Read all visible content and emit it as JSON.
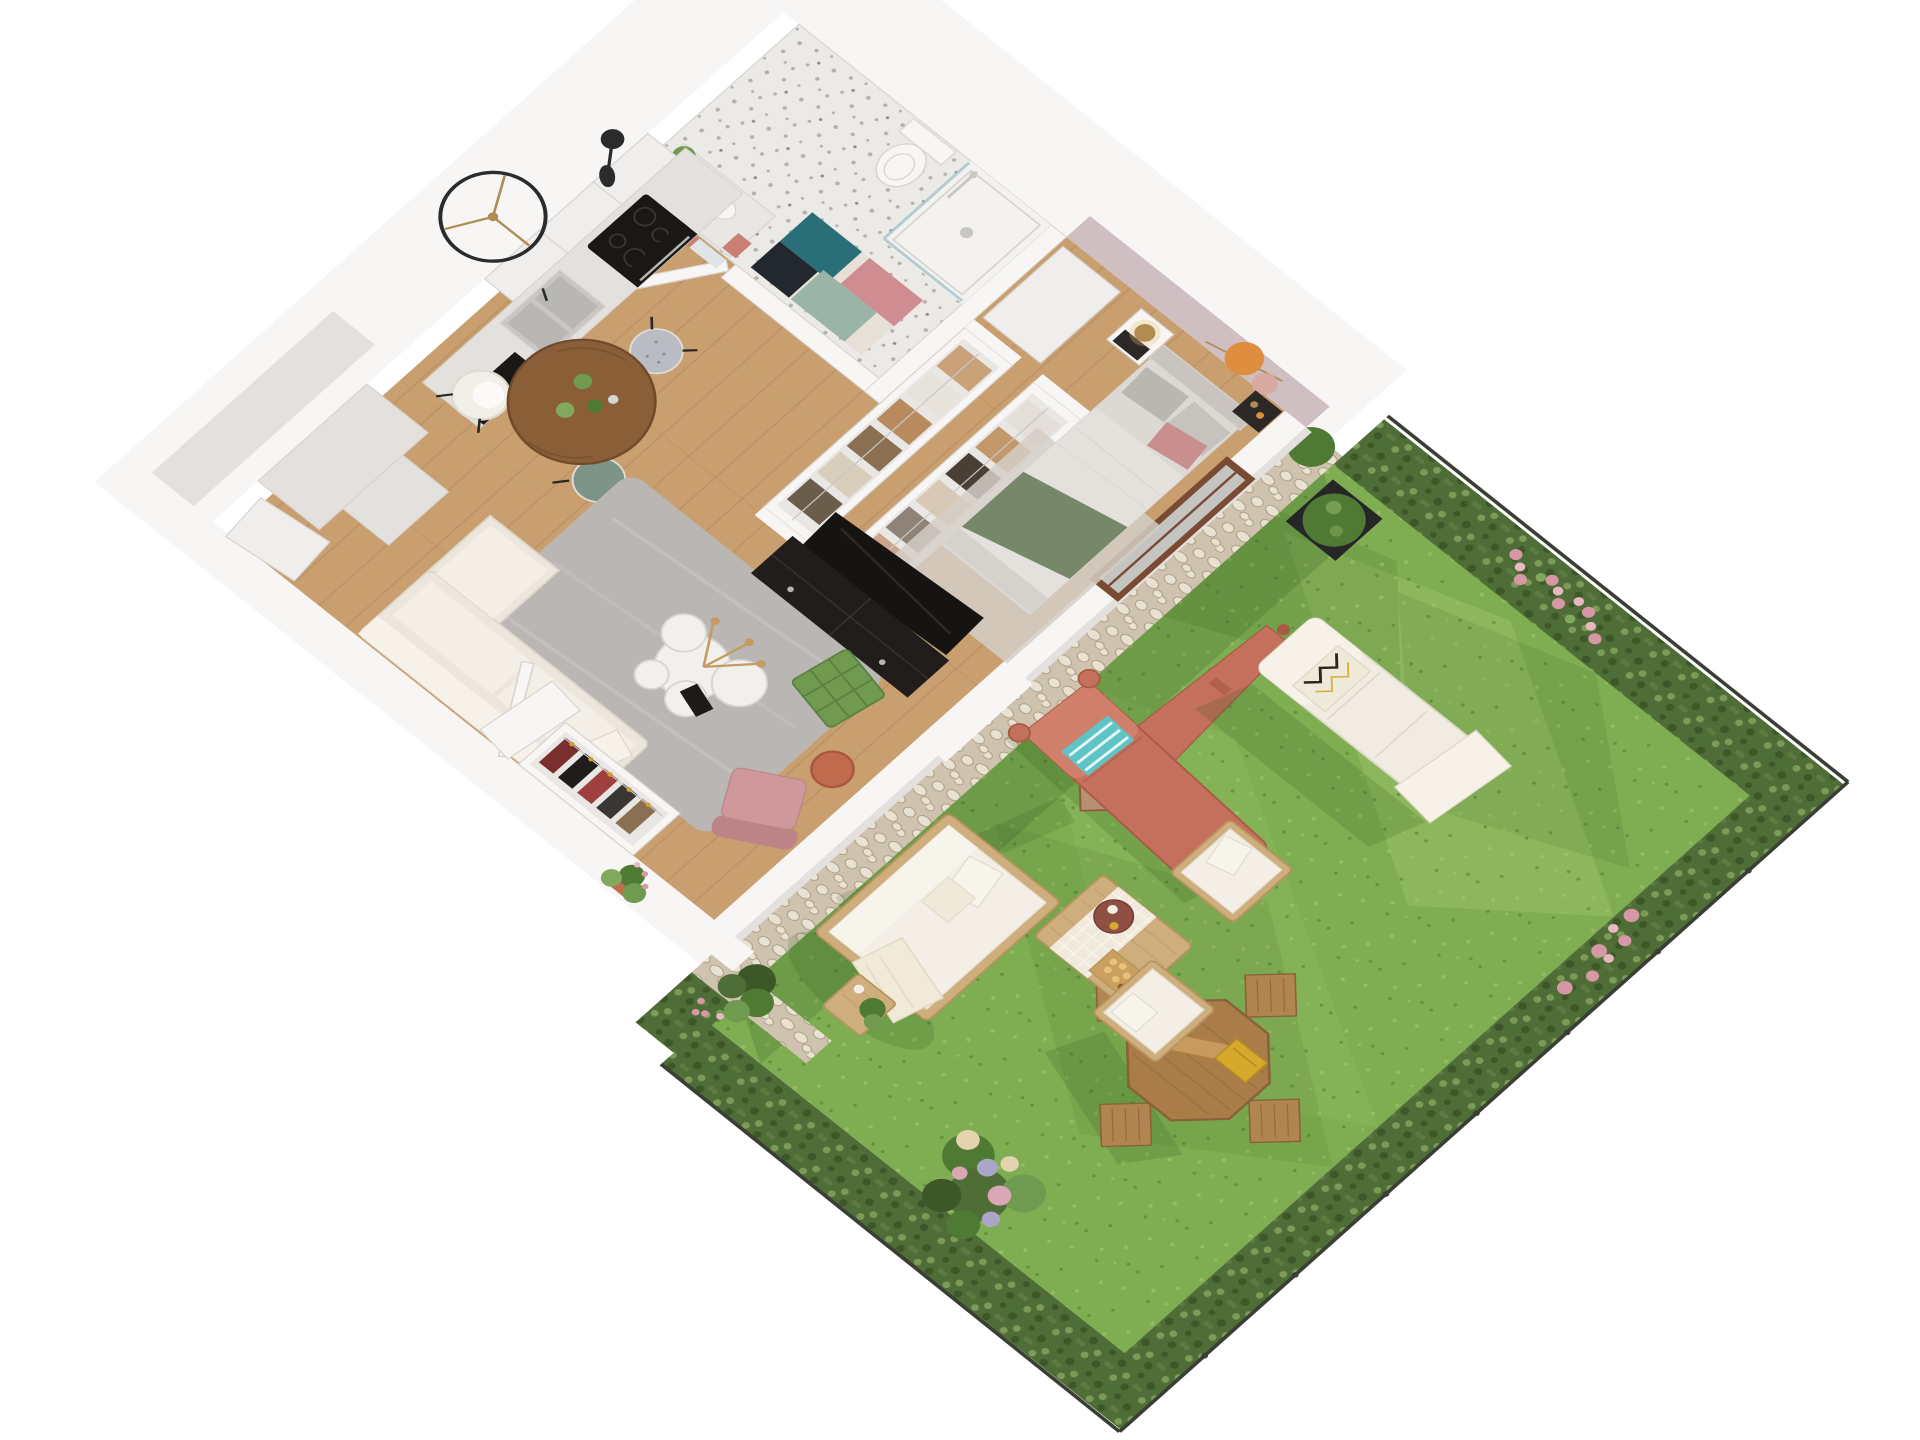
{
  "scene": {
    "view": "axonometric-3d-floor-plan-render",
    "apartment": {
      "rooms": {
        "bathroom": [
          "shower",
          "toilet",
          "vanity-sink",
          "mirror",
          "bath-mat",
          "bath-door",
          "terrazzo-floor"
        ],
        "walk-through-closet": [
          "wardrobe-row-a",
          "wardrobe-row-b",
          "hall-cabinet"
        ],
        "bedroom": [
          "double-bed",
          "green-throw",
          "nightstand-left",
          "nightstand-right",
          "brass-lamp",
          "wall-art-discs",
          "accent-wall",
          "bedroom-rug",
          "garden-door"
        ],
        "kitchen": [
          "upper-cabinets",
          "counter",
          "cooktop",
          "oven",
          "sink",
          "dishwasher",
          "island-blocks",
          "wall-clock",
          "wall-lamp"
        ],
        "dining": [
          "round-wood-table",
          "chair-white",
          "chair-sage",
          "chair-gray",
          "table-plants"
        ],
        "living": [
          "area-rug",
          "cream-sofa",
          "green-pouf",
          "coffee-table-cluster",
          "rust-side-table",
          "pink-armchair",
          "tv-console",
          "tv"
        ],
        "entry": [
          "front-door",
          "entry-closet-coats",
          "leaning-panel",
          "entry-plant"
        ]
      }
    },
    "garden": {
      "objects": [
        "lawn",
        "pebble-border",
        "hedge-top",
        "hedge-right",
        "hedge-bottom",
        "fence",
        "boxwood-planter",
        "closed-parasol",
        "white-lounger",
        "coral-lounger",
        "octagonal-dining-table",
        "folding-chairs",
        "garden-sofa",
        "garden-coffee-table",
        "garden-armchairs",
        "garden-side-table",
        "hydrangea-bush",
        "flower-shrubs",
        "corner-bush"
      ]
    }
  },
  "colors": {
    "wall": "#f7f6f5",
    "wall_shade": "#e3e0dd",
    "wall_edge": "#d7d4d0",
    "accent_wall": "#cfbfc3",
    "wood_floor": "#c99f6f",
    "wood_line": "#b2875c",
    "terrazzo": "#eceae7",
    "terrazzo_dot": "#b5b0aa",
    "terrazzo_dot2": "#8f8a84",
    "shower_floor": "#f3f2f0",
    "fixture": "#f7f6f4",
    "fixture_edge": "#d8d5d1",
    "steel": "#c9c7c4",
    "glass": "#a9c7cf",
    "mirror_base": "#dfe5e6",
    "mirror_teal": "#1f5e66",
    "mirror_pink": "#c97f72",
    "mat_teal": "#2a6f77",
    "mat_black": "#23272e",
    "mat_pink": "#cf8d92",
    "mat_sage": "#9ab5a8",
    "mat_cream": "#e6e0d6",
    "plant_green": "#6f9a4f",
    "plant_dark": "#4e7a33",
    "plant_light": "#82a85e",
    "cabinet": "#efeeec",
    "counter": "#e3e1de",
    "appliance_black": "#1a1817",
    "appliance_detail": "#b9b7b4",
    "dishwasher_light": "#3fd6d6",
    "clock_black": "#2b2b2b",
    "brass": "#b08c51",
    "lamp_glow": "#e8c178",
    "table_wood": "#8a5f38",
    "table_wood_dark": "#6f4a2b",
    "glass2": "#cfd8d2",
    "chair_white": "#f2efe9",
    "chair_white_edge": "#e0dcd4",
    "chair_sage": "#7d9488",
    "chair_gray": "#b9bcc4",
    "leg_black": "#2a2725",
    "rug": "#b9b6b4",
    "rug_light": "#c6c3c1",
    "sofa": "#ece6dc",
    "sofa_cushion": "#f3efe7",
    "sofa_back": "#f6f2ea",
    "sofa_edge": "#ddd6ca",
    "pouf_green": "#6f9a4f",
    "pouf_line": "#5a8140",
    "coffee_white": "#f2f0ec",
    "dried_tan": "#c39b63",
    "book_black": "#1d1b1a",
    "rust": "#c06a4e",
    "rust_dark": "#a85640",
    "armchair_pink": "#cf999c",
    "armchair_pink_dark": "#bd8487",
    "tv_black": "#201d1c",
    "tv_screen": "#161412",
    "tv_detail": "#3a3633",
    "closet_inner": "#e9e7e4",
    "wa1": "#caa27a",
    "wa2": "#e8e3da",
    "wa3": "#b88a5e",
    "wa4": "#8a6f52",
    "wa5": "#d9cdbb",
    "wa6": "#6b5d4c",
    "wb1": "#e3ded6",
    "wb2": "#c2976a",
    "wb3": "#4a3f35",
    "wb4": "#d9c9b4",
    "wb5": "#8f8377",
    "wb6": "#caa58a",
    "coat1": "#7a2e2e",
    "coat2": "#1f1d1c",
    "coat3": "#a03f3f",
    "coat4": "#3a3633",
    "coat5": "#8a6f52",
    "hanger_gold": "#c9a227",
    "bed_headboard": "#c9c4be",
    "bed_mattress": "#dcd8d3",
    "bed_duvet": "#e4e0db",
    "bed_pillow_gray": "#bab6b1",
    "bed_pillow_light": "#c6c2bd",
    "bed_pillow_pink": "#c98f8f",
    "bed_throw": "#77876a",
    "bed_rug": "#d3cec6",
    "bed_base": "#d5d1cc",
    "nightstand_dark": "#2b2826",
    "art_orange": "#df8d3f",
    "art_pink": "#d9a8a0",
    "door_frame": "#7a4a33",
    "door_glass": "#d7e4e4",
    "grass": "#7fae52",
    "grass_light": "#a7c96f",
    "grass_mid": "#93bd60",
    "grass_shadow": "#4e7a33",
    "shadow_green": "#2f5a1e",
    "pebble_bg": "#cfc3af",
    "pebble_light": "#e9e1d2",
    "pebble_dark": "#aa9d87",
    "hedge": "#4f6d36",
    "hedge_dark": "#3d5729",
    "hedge_mid": "#5d7a42",
    "hedge_light": "#7d9a56",
    "fence": "#3a3f35",
    "flower_pink": "#d698a5",
    "flower_pink_light": "#e8b7c2",
    "hyd_cream": "#e3d3ae",
    "hyd_purple": "#aaa6c8",
    "hyd_rose": "#d9a8b4",
    "planter_black": "#262626",
    "parasol": "#c4705c",
    "parasol_light": "#d89b85",
    "parasol_dark": "#a85a44",
    "lounger_white": "#f1ece1",
    "lounger_white_light": "#f6f2e8",
    "lounger_white_edge": "#ded7c8",
    "pillow_cream": "#efe9da",
    "zigzag_dark": "#2b2620",
    "zigzag_yellow": "#d4a92c",
    "lounger_coral": "#c4705c",
    "lounger_coral_light": "#cf7f6a",
    "pillow_teal": "#5fc4c6",
    "gwood": "#cfae7d",
    "gwood_dark": "#b8935f",
    "gcushion": "#f3efe6",
    "gcushion_light": "#f7f4ec",
    "gcushion_edge": "#e2dccd",
    "oct_wood": "#a97c48",
    "oct_dark": "#8a6238",
    "chairwood": "#b0854f",
    "tray_red": "#8f4f42",
    "tray_dark": "#763c32",
    "crate_yellow": "#d4a92c",
    "crate_dark": "#b58d1f",
    "crate_wood": "#caa05e",
    "fruit": "#e8c27a",
    "baguette": "#c89a5e",
    "baguette_dark": "#b0813f",
    "blanket": "#f1ead9",
    "blanket_edge": "#e2d9c2",
    "white": "#ffffff"
  }
}
